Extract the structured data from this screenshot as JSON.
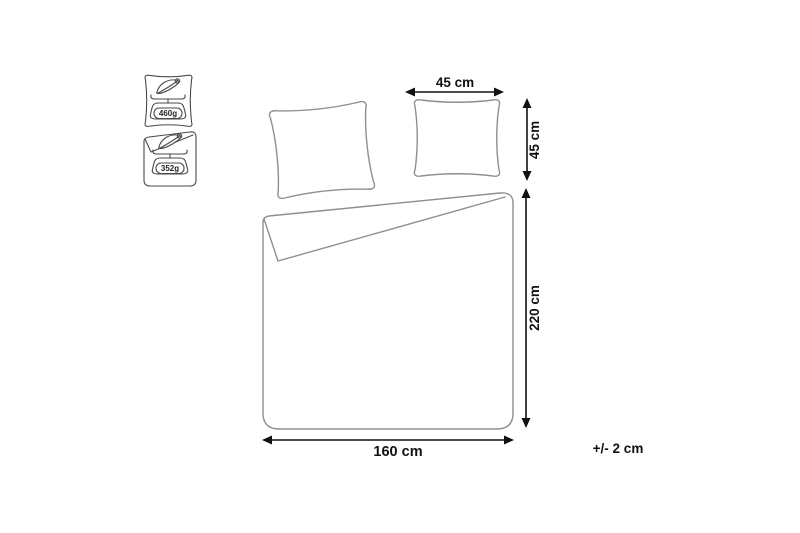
{
  "meta": {
    "background": "#ffffff",
    "outline_color": "#8f8f8f",
    "icon_outline_color": "#4a4a4a",
    "dimension_color": "#111111"
  },
  "weight_badges": {
    "pillow": {
      "item": "pillow filling weight",
      "weight": "460g"
    },
    "duvet": {
      "item": "duvet filling weight",
      "weight": "352g"
    }
  },
  "dimensions": {
    "pillow_width": "45 cm",
    "pillow_height": "45 cm",
    "duvet_length": "220 cm",
    "duvet_width": "160 cm",
    "tolerance": "+/- 2 cm"
  }
}
